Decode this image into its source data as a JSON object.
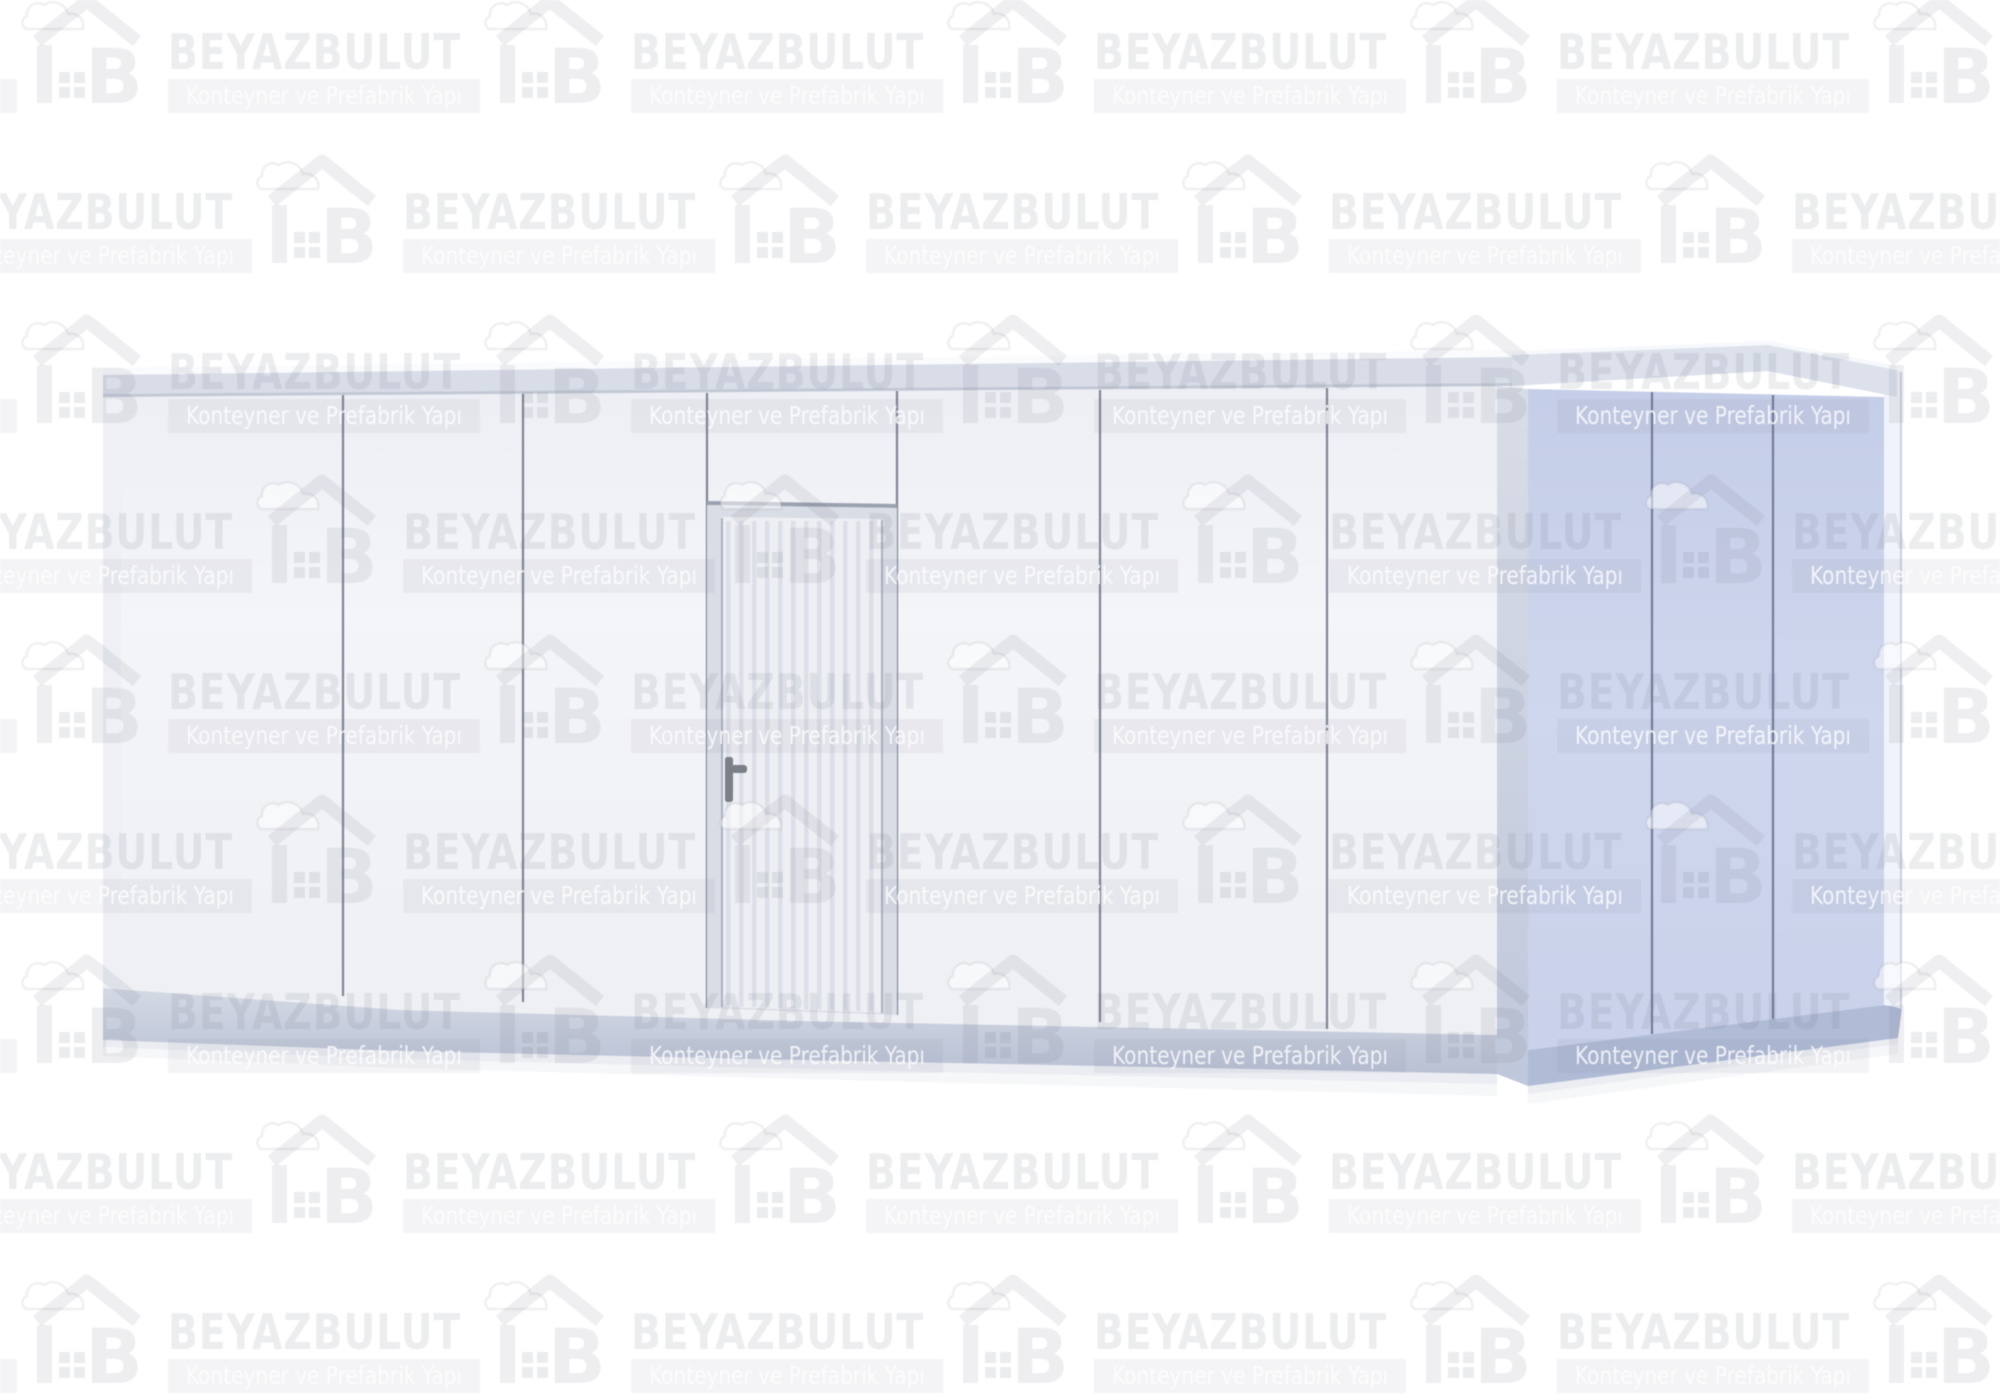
{
  "watermark": {
    "brand": "BEYAZBULUT",
    "tagline": "Konteyner ve Prefabrik Yapı",
    "logo_icon": "cloud-house-b-logo"
  },
  "scene": {
    "subject": "white prefabricated flat-pack container cabin, three-quarter view on white background",
    "front_panel_sections": 7,
    "side_panel_sections": 3,
    "door": {
      "present": true,
      "finish": "corrugated",
      "position": "fourth front section"
    }
  },
  "colors": {
    "bg": "#ffffff",
    "panel_front": "#f2f3f7",
    "panel_side": "#ccd4ec",
    "frame_light": "#d9dde8",
    "frame_mid": "#ccd2e0",
    "seam_front": "#7e8596",
    "seam_side": "#727c98",
    "base_front": "#c2c9d9",
    "base_side": "#b0bbd6",
    "door_leaf": "#edeff3",
    "door_frame": "#d9dde5",
    "door_stripe": "#dcdfe7",
    "handle": "#7b7f88",
    "watermark_ink": "#6a7080"
  }
}
